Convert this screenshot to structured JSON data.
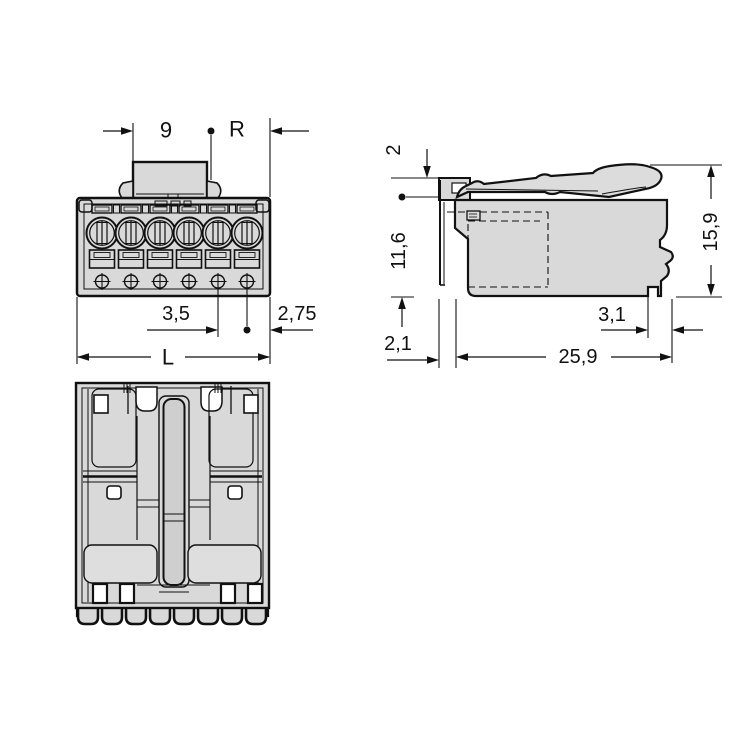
{
  "drawing": {
    "type": "connector-dimension-drawing",
    "poles": 6,
    "line_color": "#111111",
    "body_fill": "#d9d9d9",
    "lever_fill": "#dcdcdc",
    "slot_fill": "#cfcfcf",
    "background": "#ffffff",
    "dimensions": {
      "front": {
        "plug_width": "9",
        "radius_ref": "R",
        "pitch": "3,5",
        "edge_offset": "2,75",
        "total_length": "L"
      },
      "side": {
        "top_step": "2",
        "body_height": "11,6",
        "total_height": "15,9",
        "flange_depth": "2,1",
        "body_depth": "25,9",
        "latch_offset": "3,1"
      }
    }
  }
}
